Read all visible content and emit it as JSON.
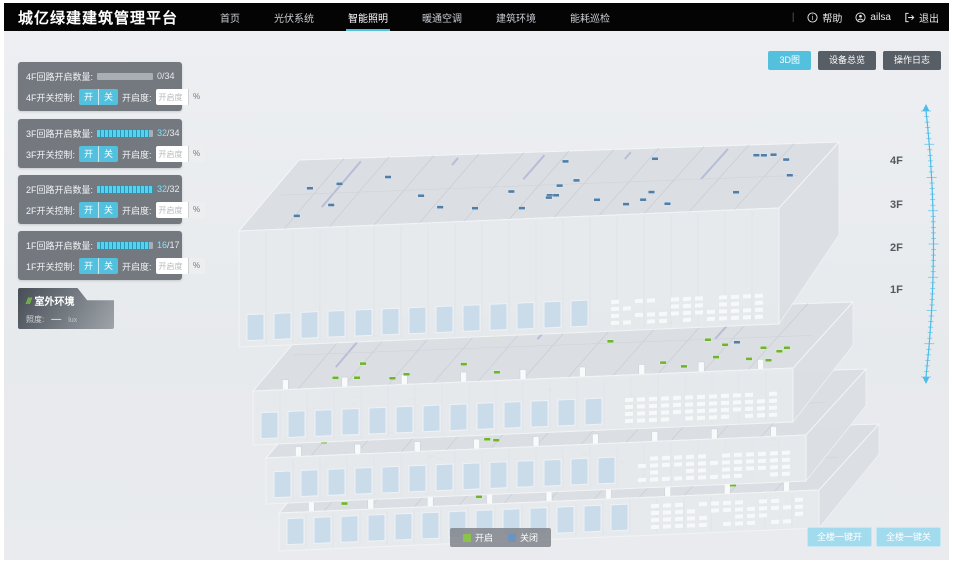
{
  "header": {
    "title": "城亿绿建建筑管理平台",
    "nav": [
      {
        "label": "首页",
        "active": false
      },
      {
        "label": "光伏系统",
        "active": false
      },
      {
        "label": "智能照明",
        "active": true
      },
      {
        "label": "暖通空调",
        "active": false
      },
      {
        "label": "建筑环境",
        "active": false
      },
      {
        "label": "能耗巡检",
        "active": false
      }
    ],
    "help_label": "帮助",
    "user_name": "ailsa",
    "logout_label": "退出"
  },
  "view_toolbar": [
    {
      "label": "3D图",
      "active": true
    },
    {
      "label": "设备总览",
      "active": false
    },
    {
      "label": "操作日志",
      "active": false
    }
  ],
  "floor_panels": [
    {
      "floor": "4F",
      "count_label": "4F回路开启数量:",
      "on_value": "0",
      "total_value": "/34",
      "pct": 0,
      "switch_label": "4F开关控制:",
      "on_label": "开",
      "off_label": "关",
      "dim_label": "开启度:",
      "dim_placeholder": "开启度",
      "percent_label": "%"
    },
    {
      "floor": "3F",
      "count_label": "3F回路开启数量:",
      "on_value": "32",
      "total_value": "/34",
      "pct": 94,
      "switch_label": "3F开关控制:",
      "on_label": "开",
      "off_label": "关",
      "dim_label": "开启度:",
      "dim_placeholder": "开启度",
      "percent_label": "%"
    },
    {
      "floor": "2F",
      "count_label": "2F回路开启数量:",
      "on_value": "32",
      "total_value": "/32",
      "pct": 100,
      "switch_label": "2F开关控制:",
      "on_label": "开",
      "off_label": "关",
      "dim_label": "开启度:",
      "dim_placeholder": "开启度",
      "percent_label": "%"
    },
    {
      "floor": "1F",
      "count_label": "1F回路开启数量:",
      "on_value": "16",
      "total_value": "/17",
      "pct": 94,
      "switch_label": "1F开关控制:",
      "on_label": "开",
      "off_label": "关",
      "dim_label": "开启度:",
      "dim_placeholder": "开启度",
      "percent_label": "%"
    }
  ],
  "outdoor": {
    "slashes": "///",
    "title": "室外环境",
    "metric_label": "照度:",
    "metric_value": "—",
    "metric_unit": "lux"
  },
  "floor_axis": [
    "4F",
    "3F",
    "2F",
    "1F"
  ],
  "legend": {
    "items": [
      {
        "label": "开启",
        "color": "#8bc34a"
      },
      {
        "label": "关闭",
        "color": "#6d93c0"
      }
    ]
  },
  "bulk_buttons": [
    {
      "label": "全楼一键开"
    },
    {
      "label": "全楼一键关"
    }
  ],
  "building": {
    "floors": [
      {
        "label": "4F",
        "on_markers": 0,
        "off_markers": 28
      },
      {
        "label": "3F",
        "on_markers": 24,
        "off_markers": 3
      },
      {
        "label": "2F",
        "on_markers": 20,
        "off_markers": 0
      },
      {
        "label": "1F",
        "on_markers": 15,
        "off_markers": 2
      }
    ]
  },
  "colors": {
    "accent": "#53c0dd",
    "topbar": "#040404",
    "background": "#e9ecef",
    "marker_on": "#6fb52c",
    "marker_off": "#4f7fa8",
    "scale": "#4bbde8"
  }
}
